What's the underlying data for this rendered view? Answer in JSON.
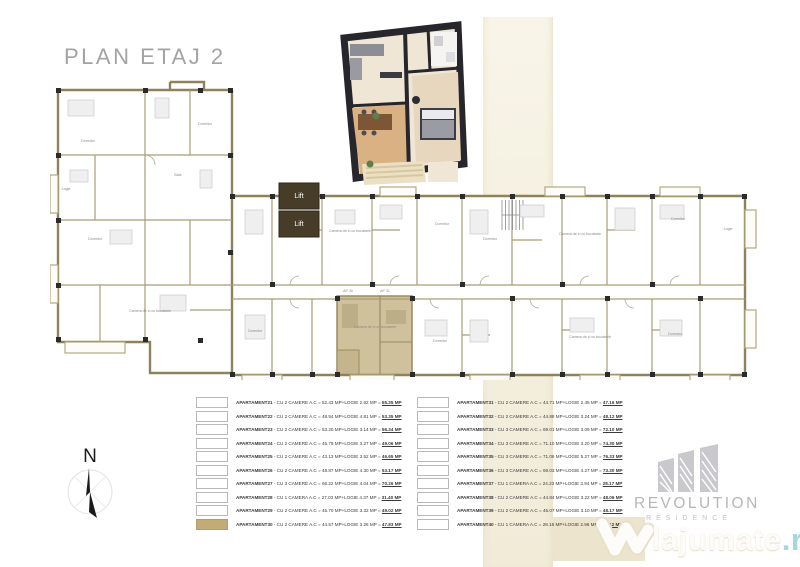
{
  "page": {
    "title": "PLAN ETAJ 2"
  },
  "compass": {
    "label": "N"
  },
  "brand": {
    "name": "REVOLUTION",
    "sub": "RESIDENCE"
  },
  "watermark": {
    "text": "lajumate",
    "tld": ".ro"
  },
  "floorplan": {
    "lift_label": "Lift",
    "highlight_color": "#cfc19c",
    "wall_color": "#8f8159",
    "labels": [
      {
        "t": "Dormitor",
        "x": 38,
        "y": 62
      },
      {
        "t": "Logie",
        "x": 16,
        "y": 110
      },
      {
        "t": "Dormitor",
        "x": 45,
        "y": 160
      },
      {
        "t": "Camera de zi cu bucatarie",
        "x": 100,
        "y": 232
      },
      {
        "t": "Baie",
        "x": 128,
        "y": 96
      },
      {
        "t": "Dormitor",
        "x": 155,
        "y": 45
      },
      {
        "t": "Camera de zi cu bucatarie",
        "x": 300,
        "y": 152
      },
      {
        "t": "Dormitor",
        "x": 392,
        "y": 145
      },
      {
        "t": "Dormitor",
        "x": 440,
        "y": 160
      },
      {
        "t": "Camera de zi cu bucatarie",
        "x": 530,
        "y": 155
      },
      {
        "t": "Dormitor",
        "x": 628,
        "y": 140
      },
      {
        "t": "Logie",
        "x": 678,
        "y": 150
      },
      {
        "t": "Dormitor",
        "x": 205,
        "y": 252
      },
      {
        "t": "Camera de zi cu bucatarie",
        "x": 325,
        "y": 248
      },
      {
        "t": "Dormitor",
        "x": 390,
        "y": 262
      },
      {
        "t": "Camera de zi cu bucatarie",
        "x": 540,
        "y": 258
      },
      {
        "t": "Dormitor",
        "x": 625,
        "y": 255
      },
      {
        "t": "AP 30",
        "x": 298,
        "y": 212
      },
      {
        "t": "AP 31",
        "x": 335,
        "y": 212
      }
    ]
  },
  "tables": {
    "left": {
      "rows": [
        {
          "name": "APARTAMENT21",
          "desc": " - CU 2 CAMERE A.C = 52.43 MP+LOGIE 2.92 MP = ",
          "total": "55.35 MP",
          "highlighted": false
        },
        {
          "name": "APARTAMENT22",
          "desc": " - CU 2 CAMERE A.C = 48.54 MP+LOGIE 4.81 MP = ",
          "total": "53.35 MP",
          "highlighted": false
        },
        {
          "name": "APARTAMENT23",
          "desc": " - CU 2 CAMERE A.C = 53.20 MP+LOGIE 3.14 MP = ",
          "total": "56.34 MP",
          "highlighted": false
        },
        {
          "name": "APARTAMENT24",
          "desc": " - CU 2 CAMERE A.C = 45.79 MP+LOGIE 3.27 MP = ",
          "total": "49.06 MP",
          "highlighted": false
        },
        {
          "name": "APARTAMENT25",
          "desc": " - CU 2 CAMERE A.C = 43.13 MP+LOGIE 3.52 MP = ",
          "total": "46.65 MP",
          "highlighted": false
        },
        {
          "name": "APARTAMENT26",
          "desc": " - CU 2 CAMERE A.C = 48.87 MP+LOGIE 4.30 MP = ",
          "total": "53.17 MP",
          "highlighted": false
        },
        {
          "name": "APARTAMENT27",
          "desc": " - CU 3 CAMERE A.C = 66.22 MP+LOGIE 4.04 MP = ",
          "total": "70.26 MP",
          "highlighted": false
        },
        {
          "name": "APARTAMENT28",
          "desc": " - CU 1 CAMERA A.C = 27.03 MP+LOGIE 4.37 MP = ",
          "total": "31.40 MP",
          "highlighted": false
        },
        {
          "name": "APARTAMENT29",
          "desc": " - CU 2 CAMERE A.C = 45.70 MP+LOGIE 3.32 MP = ",
          "total": "49.02 MP",
          "highlighted": false
        },
        {
          "name": "APARTAMENT30",
          "desc": " - CU 2 CAMERE A.C = 44.57 MP+LOGIE 3.26 MP = ",
          "total": "47.83 MP",
          "highlighted": true
        }
      ]
    },
    "right": {
      "rows": [
        {
          "name": "APARTAMENT31",
          "desc": " - CU 2 CAMERE A.C = 44.71 MP+LOGIE 2.45 MP = ",
          "total": "47.16 MP",
          "highlighted": false
        },
        {
          "name": "APARTAMENT32",
          "desc": " - CU 2 CAMERE A.C = 44.88 MP+LOGIE 3.24 MP = ",
          "total": "48.12 MP",
          "highlighted": false
        },
        {
          "name": "APARTAMENT33",
          "desc": " - CU 3 CAMERE A.C = 69.01 MP+LOGIE 3.09 MP = ",
          "total": "72.10 MP",
          "highlighted": false
        },
        {
          "name": "APARTAMENT34",
          "desc": " - CU 3 CAMERE A.C = 71.10 MP+LOGIE 3.20 MP = ",
          "total": "74.30 MP",
          "highlighted": false
        },
        {
          "name": "APARTAMENT35",
          "desc": " - CU 3 CAMERE A.C = 71.06 MP+LOGIE 5.27 MP = ",
          "total": "76.33 MP",
          "highlighted": false
        },
        {
          "name": "APARTAMENT36",
          "desc": " - CU 3 CAMERE A.C = 69.03 MP+LOGIE 4.27 MP = ",
          "total": "73.30 MP",
          "highlighted": false
        },
        {
          "name": "APARTAMENT37",
          "desc": " - CU 1 CAMERA A.C = 24.23 MP+LOGIE 3.94 MP = ",
          "total": "28.17 MP",
          "highlighted": false
        },
        {
          "name": "APARTAMENT38",
          "desc": " - CU 2 CAMERE A.C = 44.84 MP+LOGIE 3.22 MP = ",
          "total": "48.06 MP",
          "highlighted": false
        },
        {
          "name": "APARTAMENT39",
          "desc": " - CU 2 CAMERE A.C = 45.07 MP+LOGIE 3.10 MP = ",
          "total": "48.17 MP",
          "highlighted": false
        },
        {
          "name": "APARTAMENT40",
          "desc": " - CU 1 CAMERA A.C = 28.16 MP+LOGIE 2.96 MP = ",
          "total": "31.12 MP",
          "highlighted": false
        }
      ]
    }
  }
}
